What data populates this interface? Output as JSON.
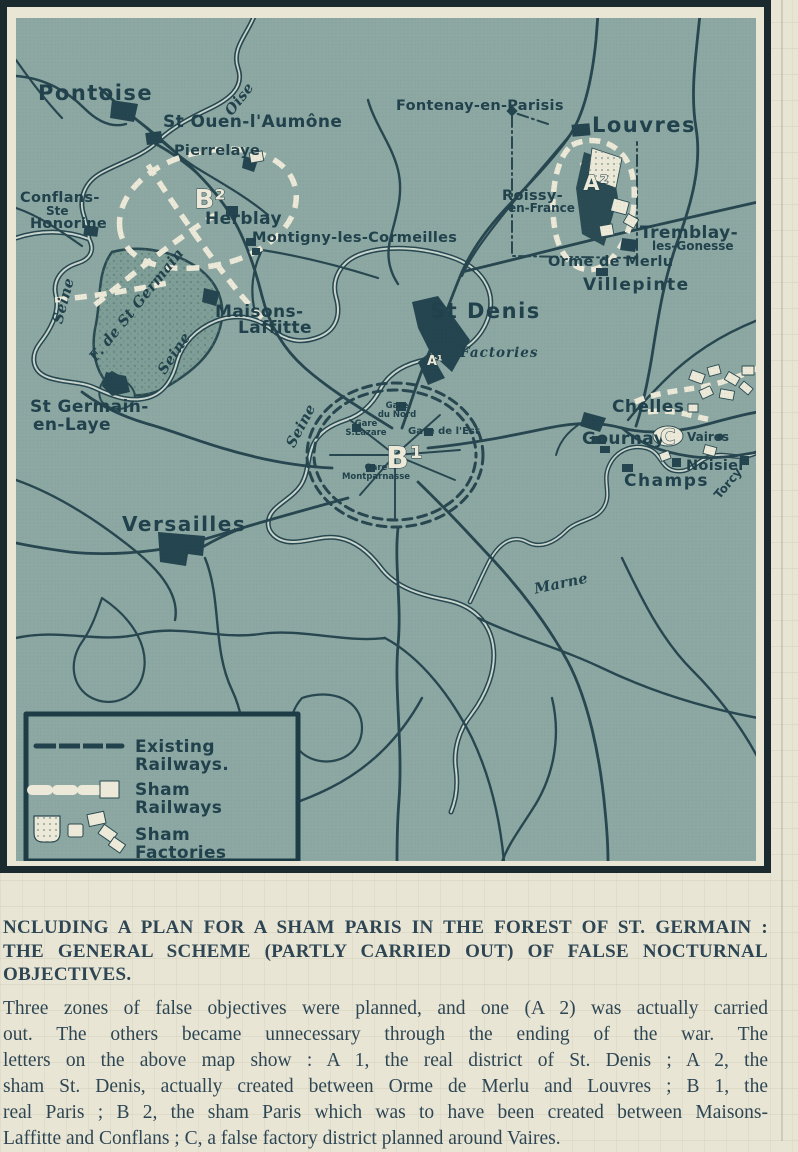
{
  "colors": {
    "paper": "#e8e5d4",
    "map_background": "#8da8a3",
    "map_ink": "#24434d",
    "sham_cream": "#ece9d8",
    "caption_ink": "#2e4654"
  },
  "map": {
    "rivers": {
      "oise": "Oise",
      "seine_a": "Seine",
      "seine_b": "Seine",
      "seine_c": "Seine",
      "marne": "Marne"
    },
    "places": {
      "pontoise": "Pontoise",
      "st_ouen": "St Ouen-l'Aumône",
      "pierrelaye": "Pierrelaye",
      "conflans_1": "Conflans-",
      "conflans_2": "Ste",
      "conflans_3": "Honorine",
      "herblay": "Herblay",
      "montigny": "Montigny-les-Cormeilles",
      "fontenay": "Fontenay-en-Parisis",
      "louvres": "Louvres",
      "roissy_1": "Roissy-",
      "roissy_2": "en-France",
      "tremblay_1": "Tremblay-",
      "tremblay_2": "les-Gonesse",
      "orme": "Orme de Merlu",
      "villepinte": "Villepinte",
      "forest": "F. de St Germain",
      "maisons_1": "Maisons-",
      "maisons_2": "Laffitte",
      "st_denis": "St Denis",
      "factories": "Factories",
      "st_germain_1": "St Germain-",
      "st_germain_2": "en-Laye",
      "gare_nord_1": "Gare",
      "gare_nord_2": "du Nord",
      "gare_lazare_1": "Gare",
      "gare_lazare_2": "S.Lazare",
      "gare_est": "Gare de l'Est",
      "gare_mont_1": "Gare",
      "gare_mont_2": "Montparnasse",
      "chelles": "Chelles",
      "gournay": "Gournay",
      "vaires": "Vaires",
      "noisiel": "Noisiel",
      "champs": "Champs",
      "torcy": "Torcy",
      "versailles": "Versailles"
    },
    "zones": {
      "a1": "A¹",
      "a2": "A²",
      "b1": "B¹",
      "b2": "B²",
      "c": "C"
    },
    "legend": {
      "existing_1": "Existing",
      "existing_2": "Railways.",
      "sham_rail_1": "Sham",
      "sham_rail_2": "Railways",
      "sham_fact_1": "Sham",
      "sham_fact_2": "Factories"
    }
  },
  "caption": {
    "headline_lines": [
      "NCLUDING A PLAN FOR A SHAM PARIS IN THE FOREST OF ST. GERMAIN :",
      "THE GENERAL SCHEME (PARTLY CARRIED OUT) OF FALSE NOCTURNAL OBJECTIVES."
    ],
    "body_lines": [
      "Three zones of false objectives were planned, and one (A 2) was actually carried",
      "out.  The others became unnecessary through the ending of the war.  The",
      "letters on the above map show : A 1, the real district of St. Denis ; A 2, the",
      "sham St. Denis, actually created between Orme de Merlu and Louvres ; B 1, the",
      "real Paris ; B 2, the sham Paris which was to have been created between Maisons-",
      "Laffitte and Conflans ; C, a false factory district planned around Vaires."
    ]
  }
}
